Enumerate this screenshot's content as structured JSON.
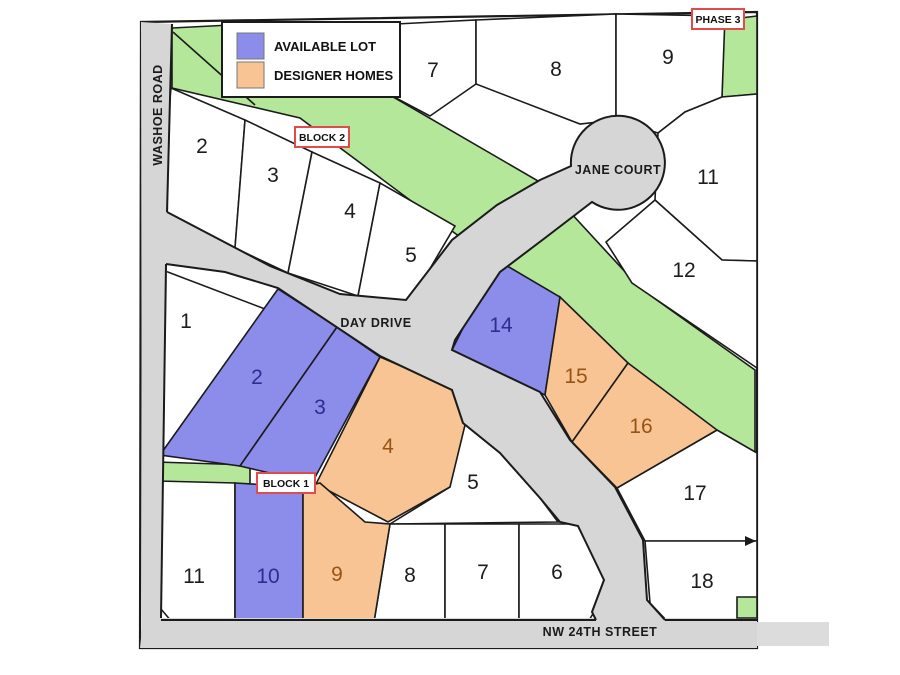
{
  "legend": {
    "items": [
      {
        "label": "AVAILABLE LOT",
        "status": "available",
        "color": "#8C8CEA"
      },
      {
        "label": "DESIGNER HOMES",
        "status": "designer",
        "color": "#F8C494"
      }
    ]
  },
  "badges": {
    "phase3": "PHASE 3",
    "block2": "BLOCK 2",
    "block1": "BLOCK 1"
  },
  "streets": {
    "washoe_road": "WASHOE ROAD",
    "day_drive": "DAY DRIVE",
    "jane_court": "JANE COURT",
    "nw_24th_street": "NW 24TH STREET"
  },
  "colors": {
    "available_lot": "#8C8CEA",
    "designer_home": "#F8C494",
    "green_space": "#B5E79B",
    "road": "#D6D6D6",
    "outline": "#1b1b1b",
    "badge_border": "#E14B4B",
    "available_number": "#2D2D92",
    "designer_number": "#975415"
  },
  "lots": [
    {
      "number": "1",
      "status": "standard"
    },
    {
      "number": "2",
      "status": "standard"
    },
    {
      "number": "3",
      "status": "standard"
    },
    {
      "number": "4",
      "status": "standard"
    },
    {
      "number": "5",
      "status": "standard"
    },
    {
      "number": "7",
      "status": "standard"
    },
    {
      "number": "8",
      "status": "standard"
    },
    {
      "number": "9",
      "status": "standard"
    },
    {
      "number": "11",
      "status": "standard"
    },
    {
      "number": "12",
      "status": "standard"
    },
    {
      "number": "5",
      "status": "standard"
    },
    {
      "number": "17",
      "status": "standard"
    },
    {
      "number": "18",
      "status": "standard"
    },
    {
      "number": "11",
      "status": "standard"
    },
    {
      "number": "8",
      "status": "standard"
    },
    {
      "number": "7",
      "status": "standard"
    },
    {
      "number": "6",
      "status": "standard"
    },
    {
      "number": "2",
      "status": "available"
    },
    {
      "number": "3",
      "status": "available"
    },
    {
      "number": "14",
      "status": "available"
    },
    {
      "number": "10",
      "status": "available"
    },
    {
      "number": "4",
      "status": "designer"
    },
    {
      "number": "15",
      "status": "designer"
    },
    {
      "number": "16",
      "status": "designer"
    },
    {
      "number": "9",
      "status": "designer"
    }
  ]
}
